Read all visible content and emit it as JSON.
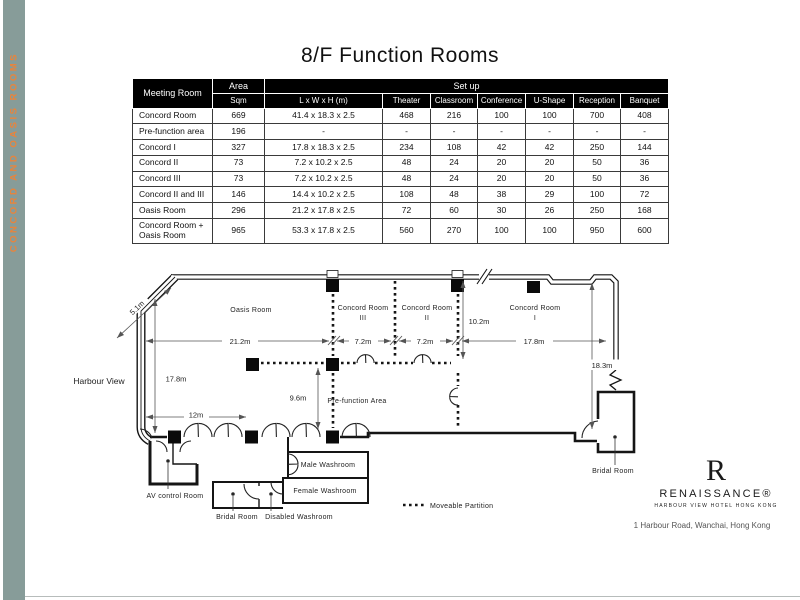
{
  "page": {
    "title": "8/F Function Rooms"
  },
  "sidebar": {
    "label": "CONCORD AND OASIS ROOMS",
    "bar_color": "#879c99",
    "text_color": "#e8843c"
  },
  "table": {
    "headers": {
      "meeting_room": "Meeting Room",
      "area": "Area",
      "sqm": "Sqm",
      "setup": "Set up",
      "dims": "L x W x H (m)",
      "theater": "Theater",
      "classroom": "Classroom",
      "conference": "Conference",
      "ushape": "U-Shape",
      "reception": "Reception",
      "banquet": "Banquet"
    },
    "rows": [
      [
        "Concord Room",
        "669",
        "41.4 x 18.3 x 2.5",
        "468",
        "216",
        "100",
        "100",
        "700",
        "408"
      ],
      [
        "Pre-function area",
        "196",
        "-",
        "-",
        "-",
        "-",
        "-",
        "-",
        "-"
      ],
      [
        "Concord I",
        "327",
        "17.8 x 18.3 x 2.5",
        "234",
        "108",
        "42",
        "42",
        "250",
        "144"
      ],
      [
        "Concord II",
        "73",
        "7.2 x 10.2 x 2.5",
        "48",
        "24",
        "20",
        "20",
        "50",
        "36"
      ],
      [
        "Concord III",
        "73",
        "7.2 x 10.2 x 2.5",
        "48",
        "24",
        "20",
        "20",
        "50",
        "36"
      ],
      [
        "Concord II and III",
        "146",
        "14.4 x 10.2 x 2.5",
        "108",
        "48",
        "38",
        "29",
        "100",
        "72"
      ],
      [
        "Oasis Room",
        "296",
        "21.2 x 17.8 x 2.5",
        "72",
        "60",
        "30",
        "26",
        "250",
        "168"
      ],
      [
        "Concord Room + Oasis Room",
        "965",
        "53.3 x 17.8 x 2.5",
        "560",
        "270",
        "100",
        "100",
        "950",
        "600"
      ]
    ]
  },
  "plan": {
    "labels": {
      "harbour_view": "Harbour View",
      "oasis": "Oasis Room",
      "concord": "Concord Room",
      "c3": "III",
      "c2": "II",
      "c1": "I",
      "prefunction": "Pre-function Area",
      "male_washroom": "Male Washroom",
      "female_washroom": "Female Washroom",
      "bridal_room": "Bridal Room",
      "disabled_washroom": "Disabled Washroom",
      "av_control": "AV control Room",
      "legend": "Moveable Partition"
    },
    "dims": {
      "oasis_w": "21.2m",
      "c3_w": "7.2m",
      "c2_w": "7.2m",
      "c1_w": "17.8m",
      "c_h": "10.2m",
      "left_h": "17.8m",
      "left_w": "12m",
      "mid_h": "9.6m",
      "right_h": "18.3m",
      "diag": "5.1m"
    }
  },
  "logo": {
    "initial": "R",
    "name": "RENAISSANCE®",
    "tagline": "HARBOUR VIEW HOTEL HONG KONG",
    "address": "1 Harbour Road, Wanchai, Hong Kong"
  }
}
